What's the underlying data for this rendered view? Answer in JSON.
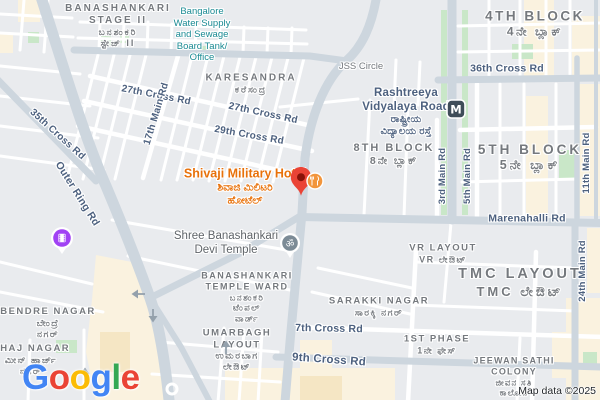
{
  "map": {
    "attribution": "Map data ©2025",
    "logo": {
      "letters": [
        {
          "ch": "G",
          "color": "#4285F4"
        },
        {
          "ch": "o",
          "color": "#EA4335"
        },
        {
          "ch": "o",
          "color": "#FBBC05"
        },
        {
          "ch": "g",
          "color": "#4285F4"
        },
        {
          "ch": "l",
          "color": "#34A853"
        },
        {
          "ch": "e",
          "color": "#EA4335"
        }
      ]
    },
    "colors": {
      "background": "#E9EBEE",
      "road_major": "#CDD6DE",
      "road_minor": "#FFFFFF",
      "park_green": "#C9E7C8",
      "commercial_cream": "#FAF2DF",
      "commercial_tan": "#F5E6C4",
      "poi_orange": "#E8710A",
      "civic_teal": "#1A8A93",
      "district_gray": "#75797E",
      "road_label_blue": "#4D617F",
      "pin_red": "#EA4335",
      "pin_red_dot": "#891208",
      "cinema_purple": "#A142F4",
      "metro_slate": "#3F4D59",
      "restaurant_orange": "#F2953C",
      "temple_gray": "#7C8B96",
      "arrow_gray": "#94A1AC"
    },
    "labels": [
      {
        "name": "label-banashankari-stage-ii",
        "cls": "district",
        "x": 118,
        "y": 26,
        "ls": 2,
        "clickable": false,
        "lines": [
          {
            "t": "BANASHANKARI",
            "s": 10
          },
          {
            "t": "STAGE II",
            "s": 10
          },
          {
            "t": "ಬನಶಂಕರಿ",
            "s": 9
          },
          {
            "t": "ಸ್ಟೇಜ್ II",
            "s": 9
          }
        ]
      },
      {
        "name": "label-bangalore-water-supply",
        "cls": "poi-teal",
        "x": 202,
        "y": 35,
        "clickable": true,
        "lines": [
          {
            "t": "Bangalore",
            "s": 9.5
          },
          {
            "t": "Water Supply",
            "s": 9.5
          },
          {
            "t": "and Sewage",
            "s": 9.5
          },
          {
            "t": "Board Tank/",
            "s": 9.5
          },
          {
            "t": "Office",
            "s": 9.5
          }
        ]
      },
      {
        "name": "label-karesandra",
        "cls": "district",
        "x": 251,
        "y": 84,
        "ls": 2,
        "clickable": false,
        "lines": [
          {
            "t": "KARESANDRA",
            "s": 10
          },
          {
            "t": "ಕರೆಸಂದ್ರ",
            "s": 9
          }
        ]
      },
      {
        "name": "label-jss-circle",
        "cls": "minor",
        "x": 361,
        "y": 67,
        "clickable": false,
        "lines": [
          {
            "t": "JSS Circle",
            "s": 9.5
          }
        ]
      },
      {
        "name": "label-4th-block",
        "cls": "district",
        "x": 535,
        "y": 24,
        "ls": 2.5,
        "clickable": false,
        "lines": [
          {
            "t": "4TH BLOCK",
            "s": 13.5
          },
          {
            "t": "4ನೇ ಬ್ಲಾಕ್",
            "s": 12
          }
        ]
      },
      {
        "name": "label-36th-cross-rd",
        "cls": "road",
        "x": 507,
        "y": 69,
        "clickable": false,
        "lines": [
          {
            "t": "36th Cross Rd",
            "s": 10.5
          }
        ]
      },
      {
        "name": "label-rashtreeya-vidyalaya-road",
        "cls": "road",
        "x": 406,
        "y": 112,
        "clickable": false,
        "lines": [
          {
            "t": "Rashtreeya",
            "s": 11.5
          },
          {
            "t": "Vidyalaya Road",
            "s": 11.5
          },
          {
            "t": "ರಾಷ್ಟ್ರೀಯ",
            "s": 10
          },
          {
            "t": "ವಿದ್ಯಾಲಯ ರಸ್ತೆ",
            "s": 10
          }
        ]
      },
      {
        "name": "label-5th-block",
        "cls": "district",
        "x": 530,
        "y": 158,
        "ls": 3,
        "clickable": false,
        "lines": [
          {
            "t": "5TH BLOCK",
            "s": 13.5
          },
          {
            "t": "5ನೇ ಬ್ಲಾಕ್",
            "s": 12.5
          }
        ]
      },
      {
        "name": "label-8th-block",
        "cls": "district",
        "x": 394,
        "y": 155,
        "ls": 2,
        "clickable": false,
        "lines": [
          {
            "t": "8TH BLOCK",
            "s": 11
          },
          {
            "t": "8ನೇ ಬ್ಲಾಕ್",
            "s": 10.5
          }
        ]
      },
      {
        "name": "label-27th-cross-rd-west",
        "cls": "road",
        "x": 156,
        "y": 96,
        "rot": 11,
        "clickable": false,
        "lines": [
          {
            "t": "27th Cross Rd",
            "s": 10
          }
        ]
      },
      {
        "name": "label-27th-cross-rd-east",
        "cls": "road",
        "x": 263,
        "y": 114,
        "rot": 12,
        "clickable": false,
        "lines": [
          {
            "t": "27th Cross Rd",
            "s": 10
          }
        ]
      },
      {
        "name": "label-29th-cross-rd",
        "cls": "road",
        "x": 249,
        "y": 136,
        "rot": 10,
        "clickable": false,
        "lines": [
          {
            "t": "29th Cross Rd",
            "s": 10
          }
        ]
      },
      {
        "name": "label-17th-main-rd",
        "cls": "road",
        "x": 157,
        "y": 114,
        "rot": -73,
        "clickable": false,
        "lines": [
          {
            "t": "17th Main Rd",
            "s": 10
          }
        ]
      },
      {
        "name": "label-35th-cross-rd",
        "cls": "road",
        "x": 57,
        "y": 135,
        "rot": 42,
        "clickable": false,
        "lines": [
          {
            "t": "35th Cross Rd",
            "s": 10
          }
        ]
      },
      {
        "name": "label-outer-ring-rd",
        "cls": "road",
        "x": 77,
        "y": 194,
        "rot": 58,
        "clickable": false,
        "lines": [
          {
            "t": "Outer Ring Rd",
            "s": 10.5
          }
        ]
      },
      {
        "name": "label-shivaji-military-hotel",
        "cls": "poi-orange",
        "x": 245,
        "y": 187,
        "clickable": true,
        "lines": [
          {
            "t": "Shivaji Military Hotel",
            "s": 12.5
          },
          {
            "t": "ಶಿವಾಜಿ ಮಿಲಿಟರಿ",
            "s": 10.5
          },
          {
            "t": "ಹೋಟೆಲ್",
            "s": 10.5
          }
        ]
      },
      {
        "name": "label-3rd-main-rd",
        "cls": "road",
        "x": 443,
        "y": 176,
        "rot": -90,
        "clickable": false,
        "lines": [
          {
            "t": "3rd Main Rd",
            "s": 9.5
          }
        ]
      },
      {
        "name": "label-5th-main-rd",
        "cls": "road",
        "x": 468,
        "y": 176,
        "rot": -90,
        "clickable": false,
        "lines": [
          {
            "t": "5th Main Rd",
            "s": 9.5
          }
        ]
      },
      {
        "name": "label-11th-main-rd",
        "cls": "road",
        "x": 587,
        "y": 163,
        "rot": -90,
        "clickable": false,
        "lines": [
          {
            "t": "11th Main Rd",
            "s": 9.5
          }
        ]
      },
      {
        "name": "label-marenahalli-rd",
        "cls": "road",
        "x": 527,
        "y": 219,
        "clickable": false,
        "lines": [
          {
            "t": "Marenahalli Rd",
            "s": 10.5
          }
        ]
      },
      {
        "name": "label-shree-banashankari-devi-temple",
        "cls": "poi-gray",
        "x": 226,
        "y": 243,
        "clickable": true,
        "lines": [
          {
            "t": "Shree Banashankari",
            "s": 11.5
          },
          {
            "t": "Devi Temple",
            "s": 11.5
          }
        ]
      },
      {
        "name": "label-vr-layout",
        "cls": "district",
        "x": 443,
        "y": 254,
        "ls": 1.5,
        "clickable": false,
        "lines": [
          {
            "t": "VR LAYOUT",
            "s": 9.5
          },
          {
            "t": "VR ಲೇಔಟ್",
            "s": 9
          }
        ]
      },
      {
        "name": "label-tmc-layout",
        "cls": "district",
        "x": 520,
        "y": 283,
        "ls": 3,
        "clickable": false,
        "lines": [
          {
            "t": "TMC LAYOUT",
            "s": 14.5
          },
          {
            "t": "TMC ಲೇಔಟ್",
            "s": 13
          }
        ]
      },
      {
        "name": "label-banashankari-temple-ward",
        "cls": "district",
        "x": 247,
        "y": 297,
        "ls": 1.5,
        "clickable": false,
        "lines": [
          {
            "t": "BANASHANKARI",
            "s": 9
          },
          {
            "t": "TEMPLE WARD",
            "s": 9
          },
          {
            "t": "ಬನಶಂಕರಿ",
            "s": 8.5
          },
          {
            "t": "ಟೆಂಪಲ್",
            "s": 8.5
          },
          {
            "t": "ವಾರ್ಡ್",
            "s": 8.5
          }
        ]
      },
      {
        "name": "label-24th-main-rd",
        "cls": "road",
        "x": 583,
        "y": 271,
        "rot": -90,
        "clickable": false,
        "lines": [
          {
            "t": "24th Main Rd",
            "s": 9.5
          }
        ]
      },
      {
        "name": "label-sarakki-nagar",
        "cls": "district",
        "x": 379,
        "y": 307,
        "ls": 1.5,
        "clickable": false,
        "lines": [
          {
            "t": "SARAKKI NAGAR",
            "s": 9.5
          },
          {
            "t": "ಸಾರಕ್ಕಿ ನಗರ್",
            "s": 9
          }
        ]
      },
      {
        "name": "label-7th-cross-rd",
        "cls": "road",
        "x": 329,
        "y": 329,
        "rot": 1,
        "clickable": false,
        "lines": [
          {
            "t": "7th Cross Rd",
            "s": 10.5
          }
        ]
      },
      {
        "name": "label-9th-cross-rd",
        "cls": "road",
        "x": 329,
        "y": 360,
        "rot": 4,
        "clickable": false,
        "lines": [
          {
            "t": "9th Cross Rd",
            "s": 11.5
          }
        ]
      },
      {
        "name": "label-1st-phase",
        "cls": "district",
        "x": 437,
        "y": 345,
        "ls": 1.5,
        "clickable": false,
        "lines": [
          {
            "t": "1ST PHASE",
            "s": 9.5
          },
          {
            "t": "1ನೇ ಫೇಸ್",
            "s": 9
          }
        ]
      },
      {
        "name": "label-bendre-nagar",
        "cls": "district",
        "x": 48,
        "y": 323,
        "ls": 1.5,
        "clickable": false,
        "lines": [
          {
            "t": "BENDRE NAGAR",
            "s": 9.5
          },
          {
            "t": "ಬೇಂದ್ರೆ",
            "s": 9
          },
          {
            "t": "ನಗರ್",
            "s": 9
          }
        ]
      },
      {
        "name": "label-minhaj-nagar",
        "cls": "district",
        "x": 31,
        "y": 360,
        "ls": 1.5,
        "clickable": false,
        "lines": [
          {
            "t": "NHAJ NAGAR",
            "s": 9.5
          },
          {
            "t": "ಮೀನ್ ಹಾರ್ಜ್",
            "s": 9
          },
          {
            "t": "ನಗರ್",
            "s": 9
          }
        ]
      },
      {
        "name": "label-umarbagh-layout",
        "cls": "district",
        "x": 237,
        "y": 350,
        "ls": 1.5,
        "clickable": false,
        "lines": [
          {
            "t": "UMARBAGH",
            "s": 9.5
          },
          {
            "t": "LAYOUT",
            "s": 9.5
          },
          {
            "t": "ಉಮರಬಾಗ",
            "s": 9
          },
          {
            "t": "ಲೇಔಟ್",
            "s": 9
          }
        ]
      },
      {
        "name": "label-jeewan-sathi-colony",
        "cls": "district",
        "x": 514,
        "y": 377,
        "ls": 1.2,
        "clickable": false,
        "lines": [
          {
            "t": "JEEWAN SATHI",
            "s": 9
          },
          {
            "t": "COLONY",
            "s": 9
          },
          {
            "t": "ಜೀವನ ಸತಿ",
            "s": 8.5
          },
          {
            "t": "ಕಾಲೋನಿ",
            "s": 8.5
          }
        ]
      }
    ],
    "pois": [
      {
        "name": "shivaji-military-hotel-pin-icon",
        "type": "red-pin",
        "x": 301,
        "y": 181
      },
      {
        "name": "restaurant-icon",
        "type": "restaurant",
        "x": 315,
        "y": 181
      },
      {
        "name": "metro-station-icon",
        "type": "metro",
        "x": 456,
        "y": 109,
        "glyph": "M"
      },
      {
        "name": "temple-om-icon",
        "type": "om",
        "x": 290,
        "y": 243,
        "glyph": "ॐ"
      },
      {
        "name": "cinema-icon",
        "type": "cinema",
        "x": 62,
        "y": 238
      }
    ],
    "arrows": [
      {
        "name": "oneway-arrow-west",
        "x": 138,
        "y": 294,
        "dir": "left"
      },
      {
        "name": "oneway-arrow-south",
        "x": 153,
        "y": 316,
        "dir": "down"
      },
      {
        "name": "oneway-arrow-up-umarbagh",
        "x": 226,
        "y": 347,
        "dir": "up"
      },
      {
        "name": "oneway-arrow-up-bendre",
        "x": 85,
        "y": 374,
        "dir": "up"
      }
    ]
  }
}
